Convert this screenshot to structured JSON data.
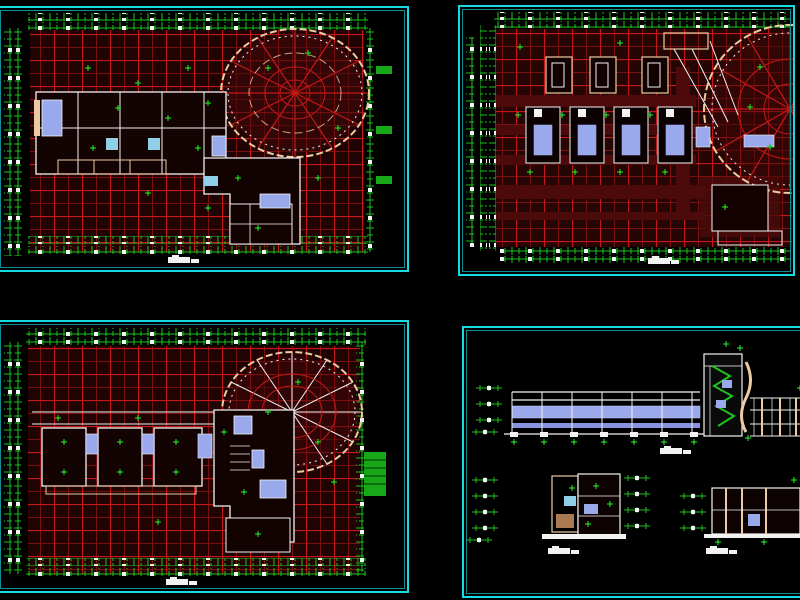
{
  "app": {
    "type": "cad-drawing-sheet",
    "description_blobs_only": true
  },
  "colors": {
    "background": "#000000",
    "cyan_border": "#16dbe2",
    "teal_inner": "#0f8e96",
    "red_bright": "#c41818",
    "red_dark": "#7a1010",
    "maroon": "#400808",
    "green": "#1cc41c",
    "lavender": "#9aa8ec",
    "blue_light": "#8fd0e8",
    "tan": "#eccba2",
    "white": "#f2f2f2"
  },
  "panels": {
    "p1": {
      "kind": "floor-plan-with-round-wing",
      "caption_blob": 1
    },
    "p2": {
      "kind": "enlarged-partial-plan-with-radial-structure",
      "caption_blob": 1
    },
    "p3": {
      "kind": "floor-plan-with-spiral-roof",
      "caption_blob": 1
    },
    "p4": {
      "kind": "building-sections-and-details",
      "caption_blob": 3
    }
  },
  "sheet": {
    "rows": 2,
    "cols": 2
  }
}
